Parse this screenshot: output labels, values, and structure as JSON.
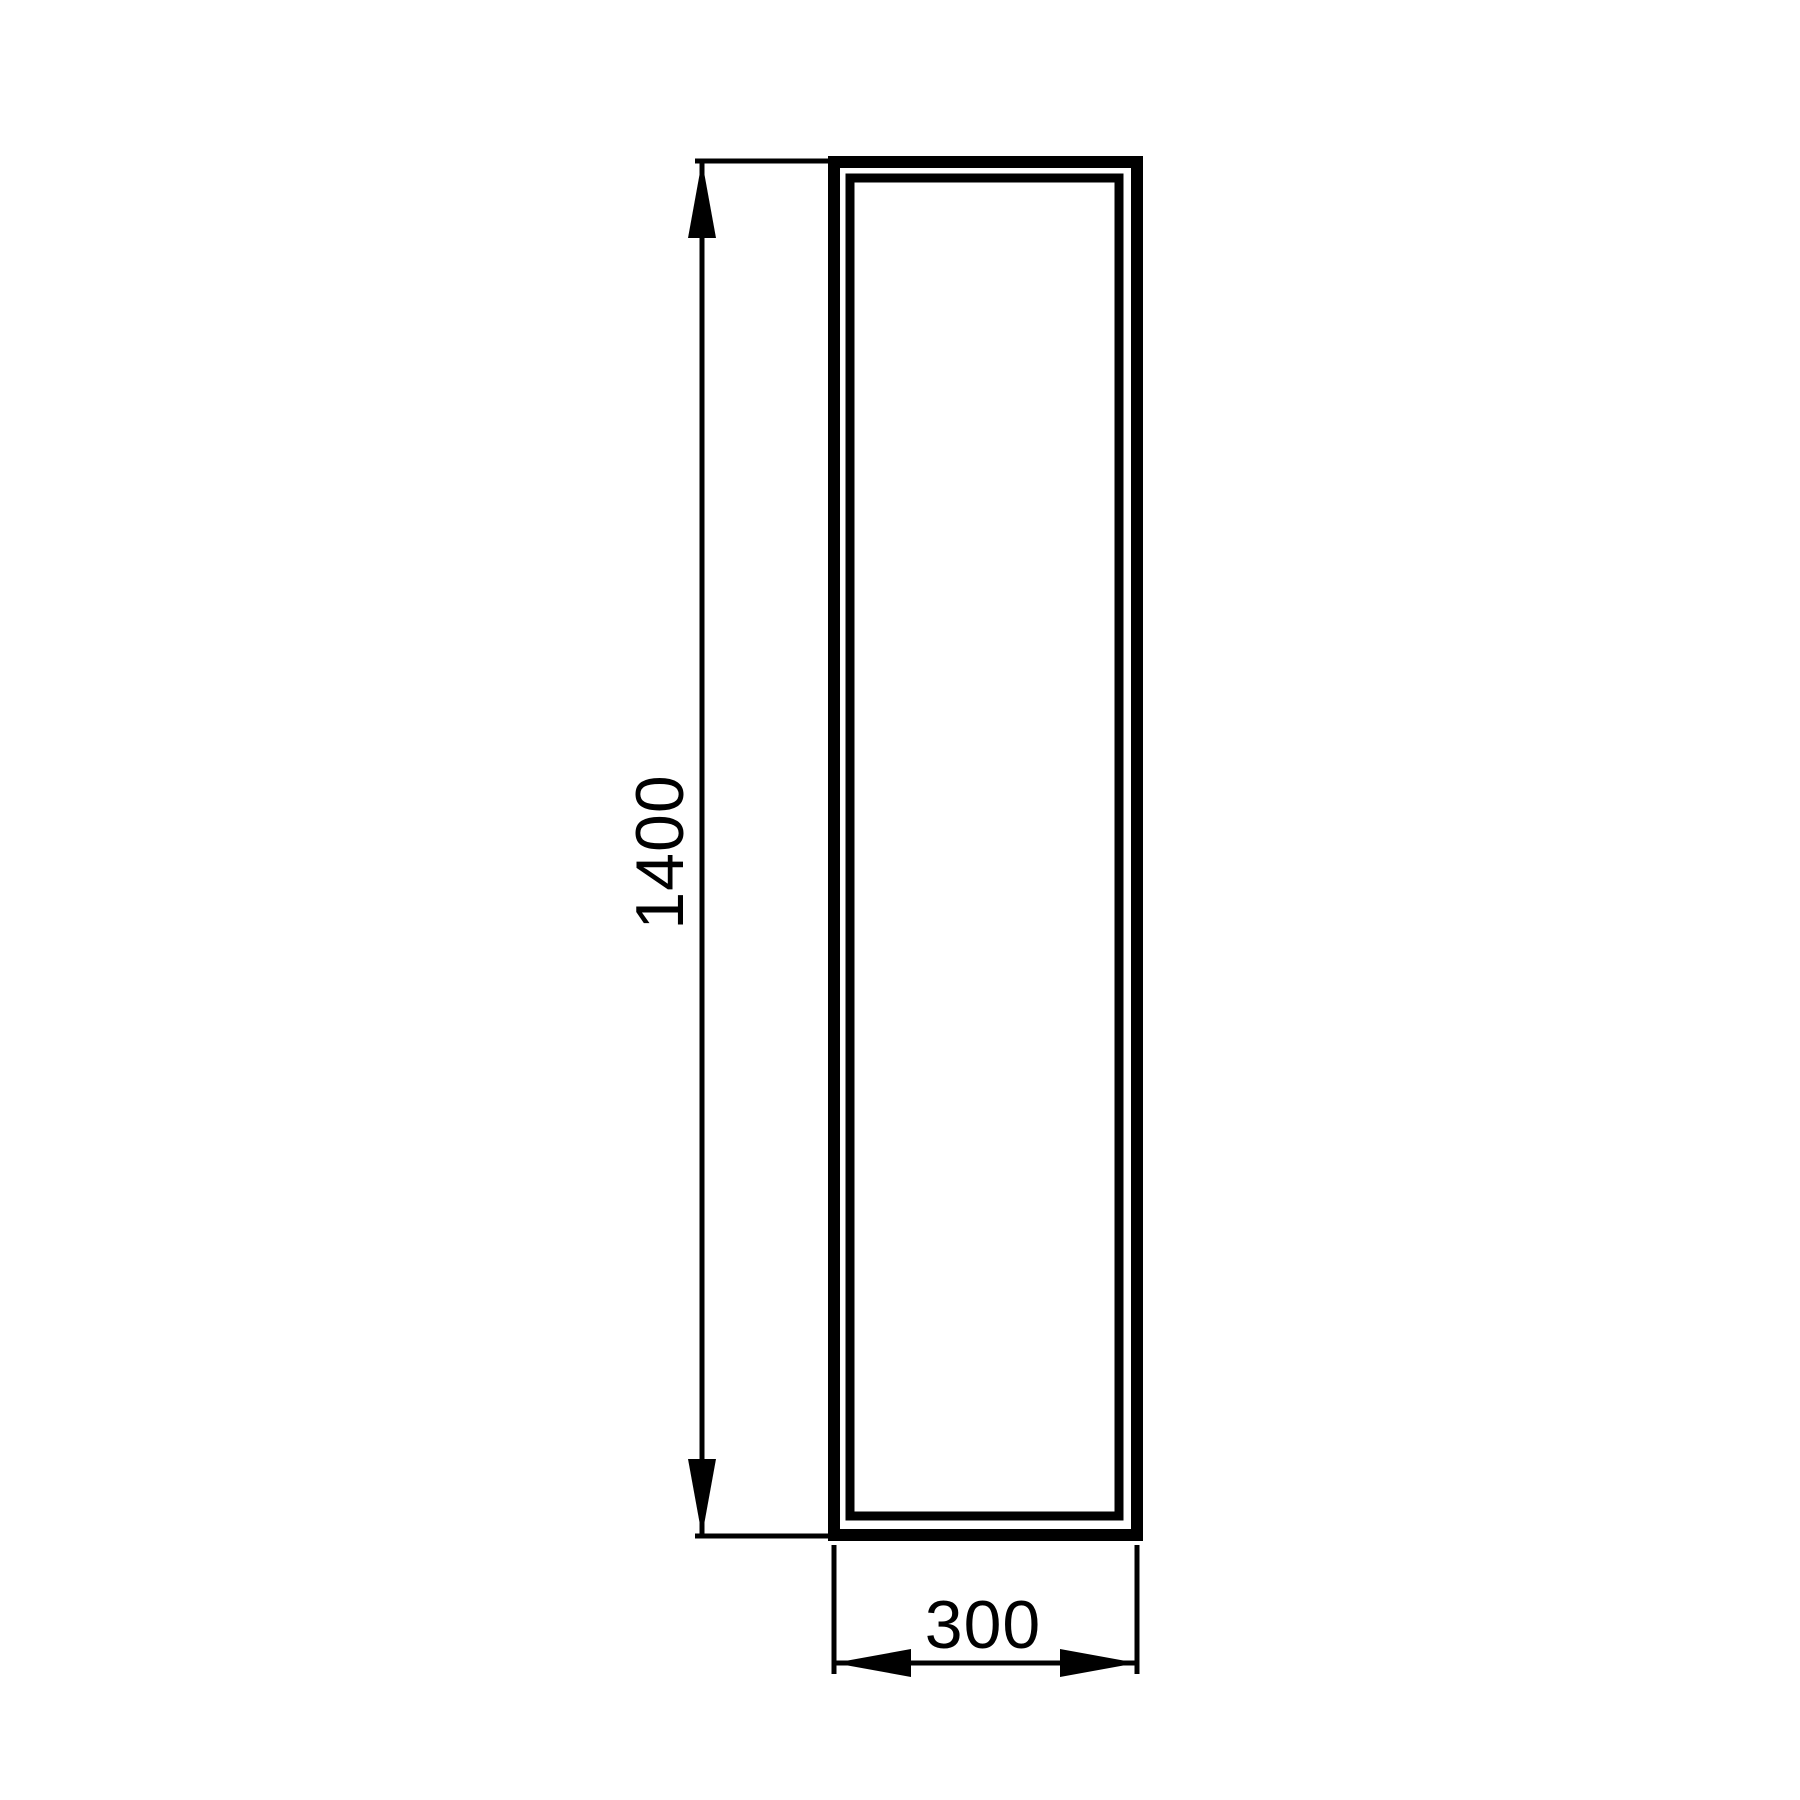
{
  "dimensions": {
    "height": {
      "value": "1400"
    },
    "width": {
      "value": "300"
    }
  },
  "colors": {
    "line": "#000000",
    "background": "#ffffff"
  }
}
